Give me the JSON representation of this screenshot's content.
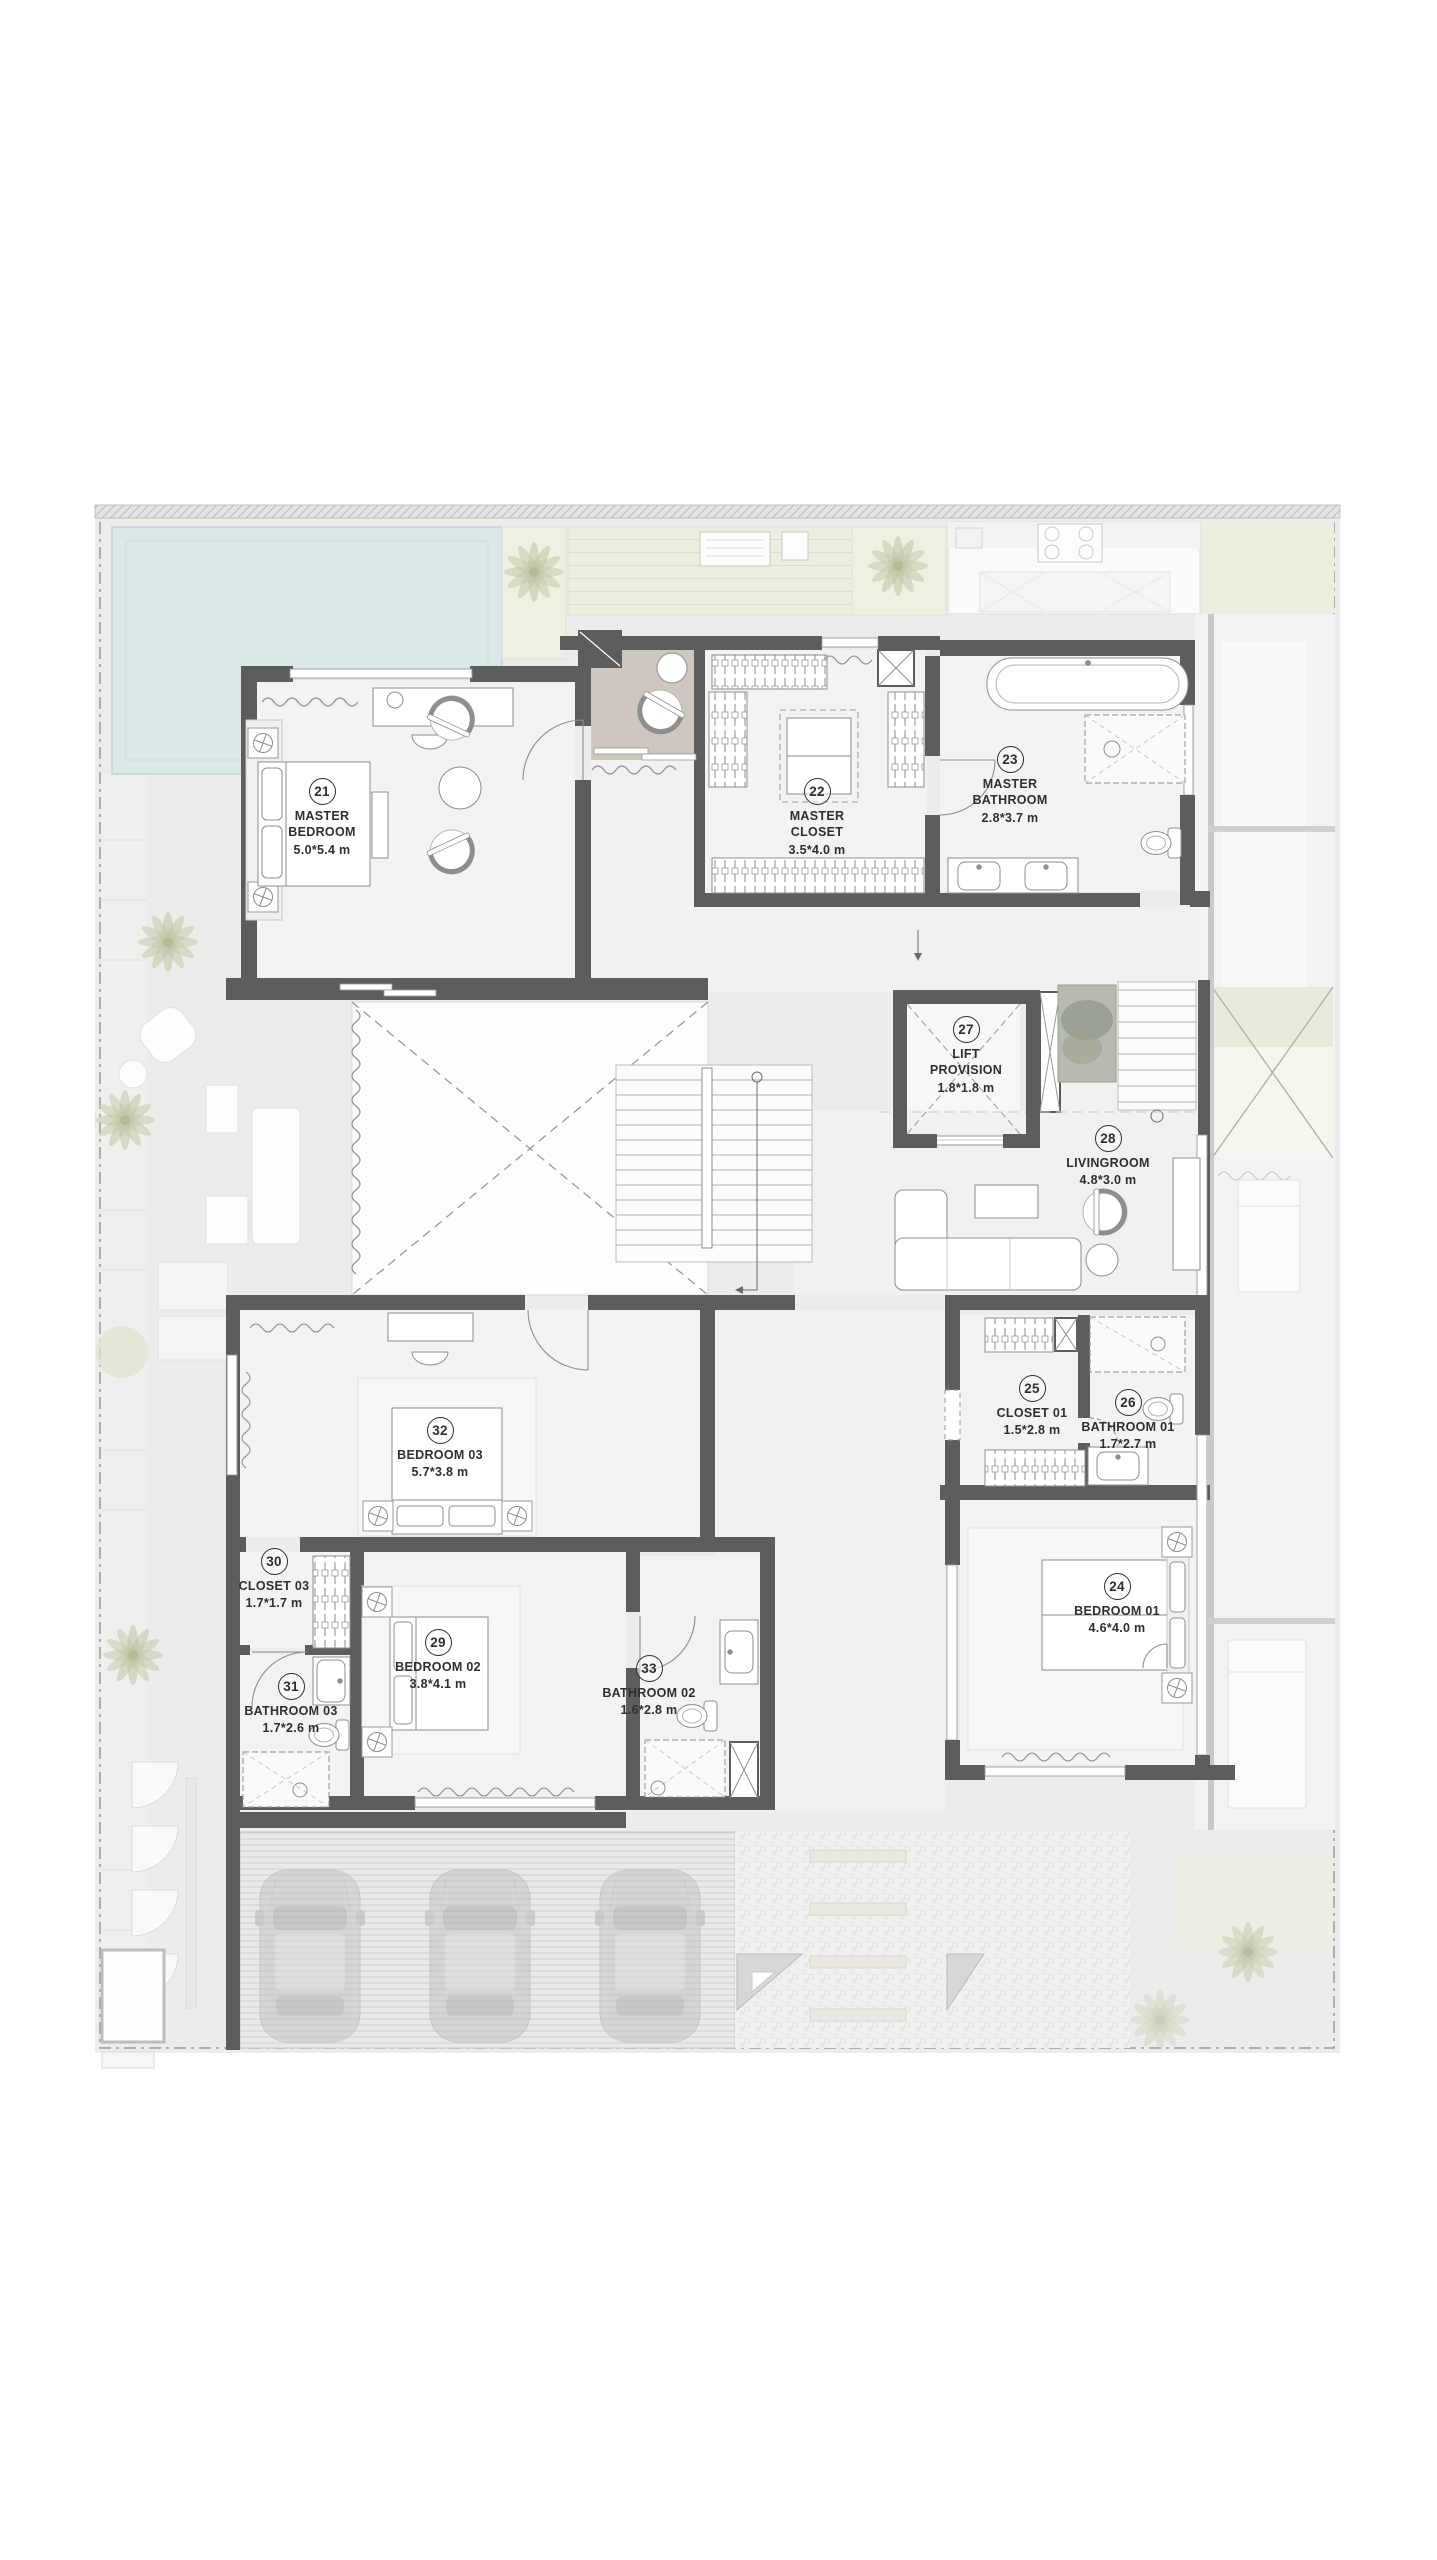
{
  "rooms": [
    {
      "number": "21",
      "name": "MASTER BEDROOM",
      "dims": "5.0*5.4 m"
    },
    {
      "number": "22",
      "name": "MASTER CLOSET",
      "dims": "3.5*4.0 m"
    },
    {
      "number": "23",
      "name": "MASTER BATHROOM",
      "dims": "2.8*3.7 m"
    },
    {
      "number": "24",
      "name": "BEDROOM 01",
      "dims": "4.6*4.0 m"
    },
    {
      "number": "25",
      "name": "CLOSET 01",
      "dims": "1.5*2.8 m"
    },
    {
      "number": "26",
      "name": "BATHROOM 01",
      "dims": "1.7*2.7 m"
    },
    {
      "number": "27",
      "name": "LIFT PROVISION",
      "dims": "1.8*1.8 m"
    },
    {
      "number": "28",
      "name": "LIVINGROOM",
      "dims": "4.8*3.0 m"
    },
    {
      "number": "29",
      "name": "BEDROOM 02",
      "dims": "3.8*4.1 m"
    },
    {
      "number": "30",
      "name": "CLOSET 03",
      "dims": "1.7*1.7 m"
    },
    {
      "number": "31",
      "name": "BATHROOM 03",
      "dims": "1.7*2.6 m"
    },
    {
      "number": "32",
      "name": "BEDROOM 03",
      "dims": "5.7*3.8 m"
    },
    {
      "number": "33",
      "name": "BATHROOM 02",
      "dims": "1.6*2.8 m"
    }
  ],
  "palette": {
    "wall": "#5d5d5c",
    "site": "#ececea",
    "floor": "#f3f3f2",
    "pool": "#dbe7e8",
    "deck": "#edeee1",
    "wood": "#cdc7c0",
    "line": "#8e8e8c",
    "label_text": "#2f2f2e"
  },
  "plan_features": {
    "outdoor": [
      "swimming-pool",
      "sun-deck",
      "palm-trees",
      "terrace-lounge",
      "garage-three-cars",
      "stepping-stone-path",
      "planters"
    ],
    "indoor": [
      "main-staircase",
      "secondary-staircase",
      "double-height-void",
      "lift-shaft",
      "wardrobes",
      "ghost-kitchen-below"
    ],
    "symbols": [
      "bed",
      "bathtub",
      "shower",
      "toilet",
      "vanity-sink",
      "sofa",
      "armchair",
      "coffee-table",
      "wall-light"
    ]
  }
}
